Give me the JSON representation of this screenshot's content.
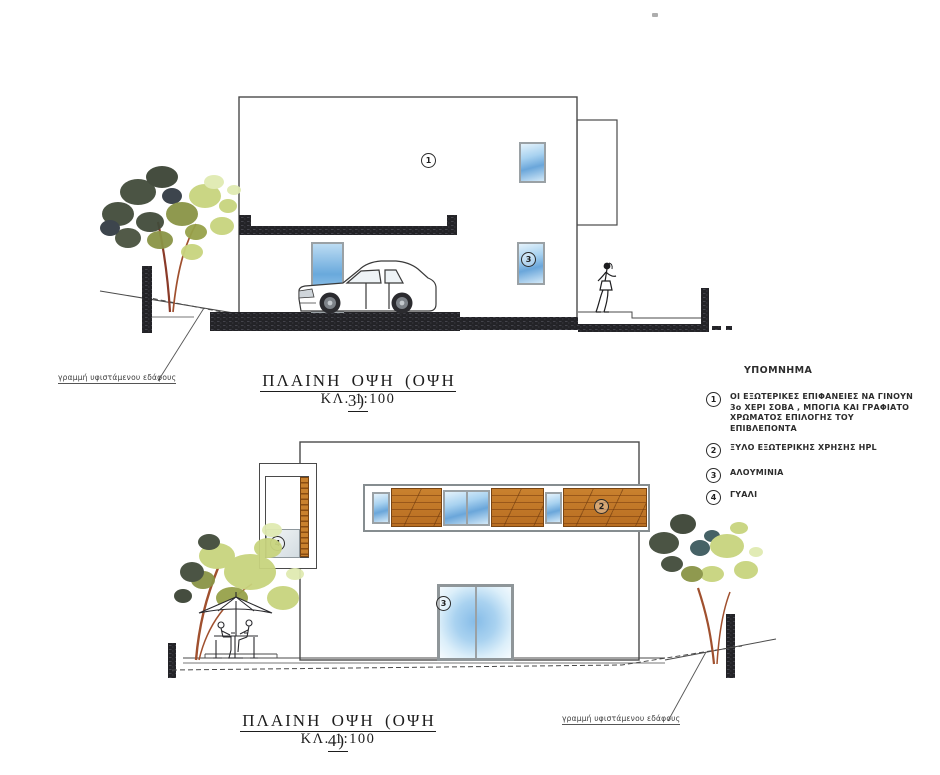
{
  "sheet": {
    "elevation3": {
      "title": "ΠΛΑΙΝΗ ΟΨΗ (ΟΨΗ 3)",
      "scale": "ΚΛ. 1:100"
    },
    "elevation4": {
      "title": "ΠΛΑΙΝΗ ΟΨΗ (ΟΨΗ 4)",
      "scale": "ΚΛ. 1:100"
    },
    "ground_label_top": "γραμμή υφιστάμενου εδάφους",
    "ground_label_bottom": "γραμμή υφιστάμενου εδάφους"
  },
  "legend": {
    "heading": "ΥΠΟΜΝΗΜΑ",
    "items": [
      {
        "num": "1",
        "text": "ΟΙ ΕΞΩΤΕΡΙΚΕΣ ΕΠΙΦΑΝΕΙΕΣ ΝΑ ΓΙΝΟΥΝ 3ο ΧΕΡΙ ΣΟΒΑ , ΜΠΟΓΙΑ ΚΑΙ ΓΡΑΦΙΑΤΟ ΧΡΩΜΑΤΟΣ ΕΠΙΛΟΓΗΣ ΤΟΥ ΕΠΙΒΛΕΠΟΝΤΑ"
      },
      {
        "num": "2",
        "text": "ΞΥΛΟ ΕΞΩΤΕΡΙΚΗΣ ΧΡΗΣΗΣ HPL"
      },
      {
        "num": "3",
        "text": "ΑΛΟΥΜΙΝΙΑ"
      },
      {
        "num": "4",
        "text": "ΓΥΑΛΙ"
      }
    ]
  },
  "callouts": {
    "c1": "1",
    "c2": "2",
    "c3": "3",
    "c4": "4"
  },
  "colors": {
    "line": "#4a4a4a",
    "dark_fixture": "#232327",
    "wood": "#c2782a",
    "glass_blue": "#6aa6da",
    "foliage_light": "#c8d47e",
    "foliage_olive": "#8a9446",
    "foliage_dark": "#424b3a",
    "trunk": "#a0502e"
  }
}
